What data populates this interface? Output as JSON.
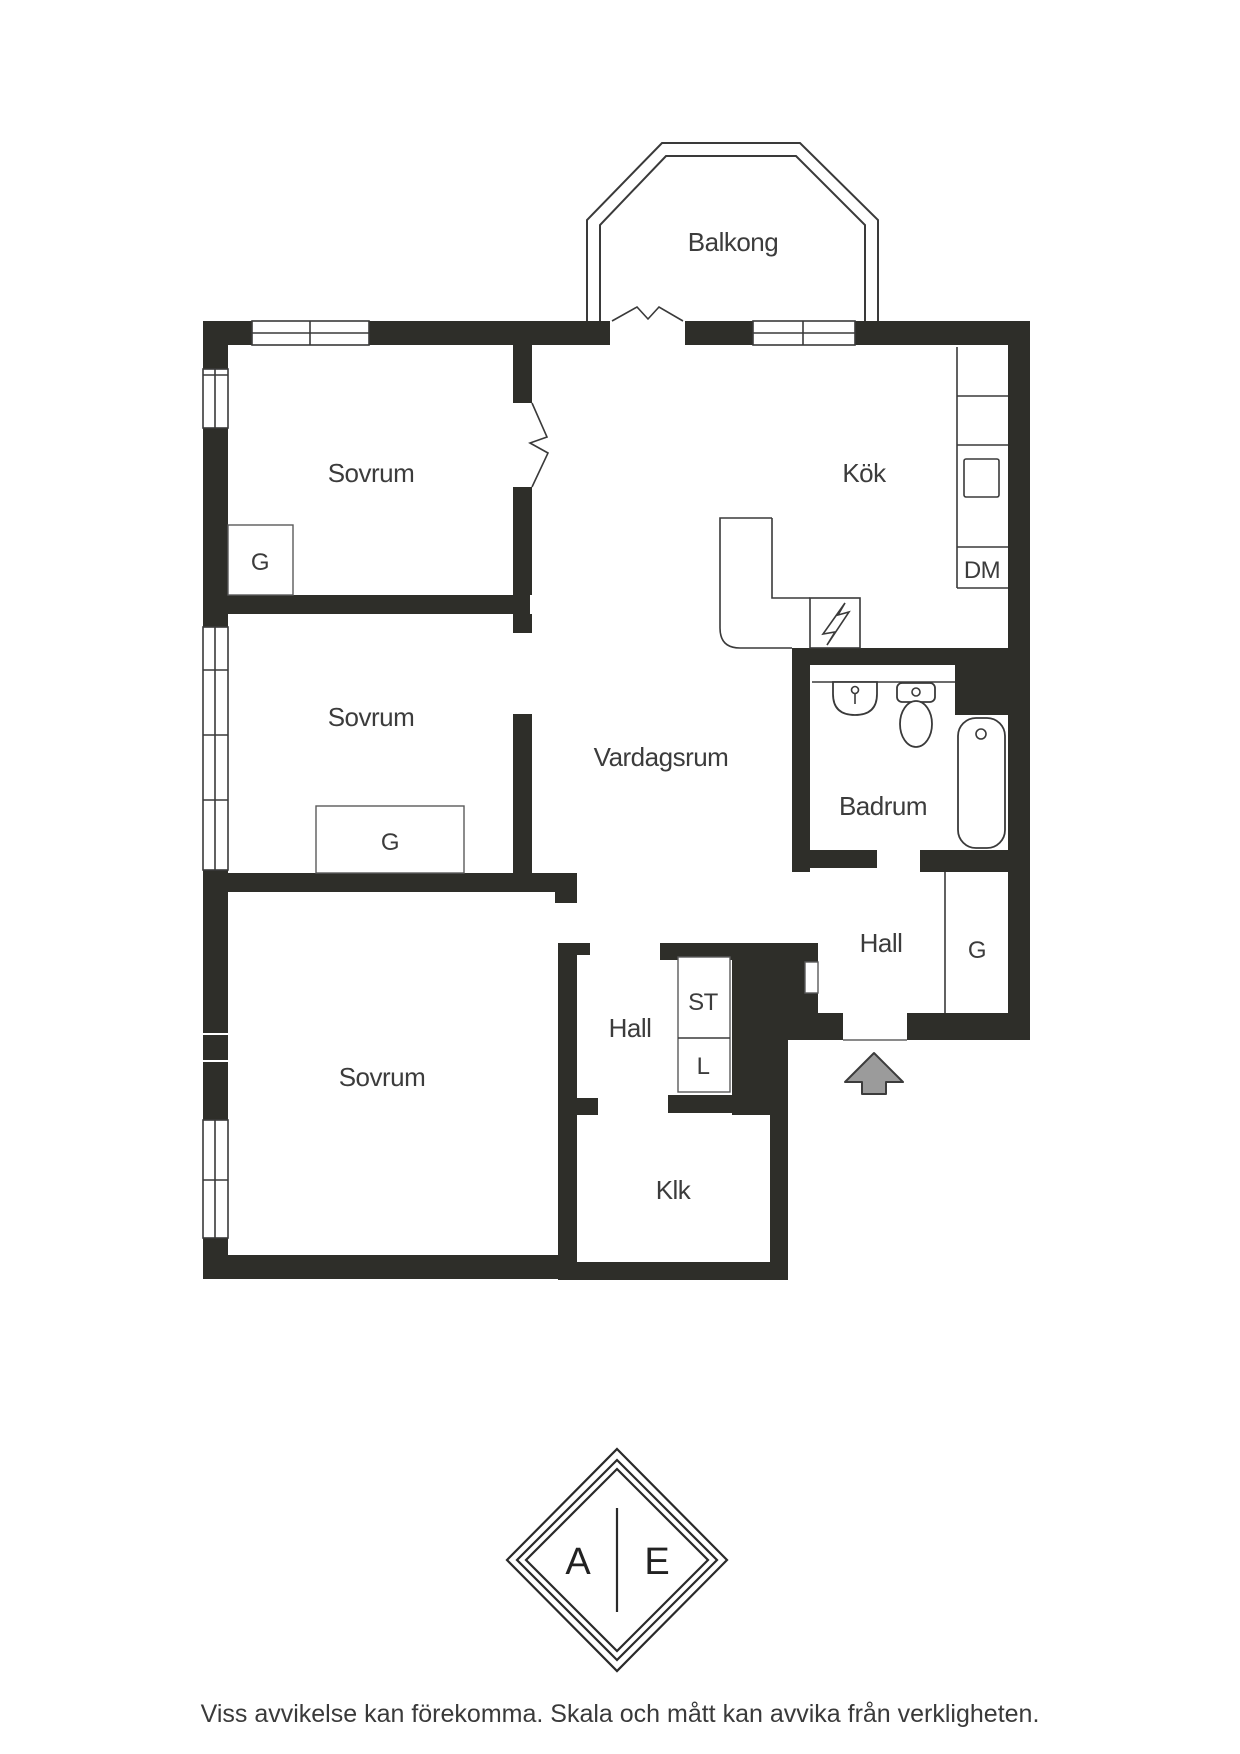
{
  "palette": {
    "wall": "#2e2e29",
    "line": "#3a3a3a",
    "text": "#3c3c3c",
    "arrow_fill": "#9b9b9b",
    "background": "#ffffff"
  },
  "plan": {
    "balcony": "Balkong",
    "bedroom1": "Sovrum",
    "bedroom2": "Sovrum",
    "bedroom3": "Sovrum",
    "kitchen": "Kök",
    "living_room": "Vardagsrum",
    "bathroom": "Badrum",
    "hall_right": "Hall",
    "hall_center": "Hall",
    "walkin_closet": "Klk",
    "wardrobe1": "G",
    "wardrobe2": "G",
    "wardrobe3": "G",
    "cleaning_closet": "ST",
    "linen_closet": "L",
    "dishwasher": "DM"
  },
  "logo": {
    "left_letter": "A",
    "right_letter": "E"
  },
  "footer": {
    "disclaimer": "Viss avvikelse kan förekomma. Skala och mått kan avvika från verkligheten."
  }
}
